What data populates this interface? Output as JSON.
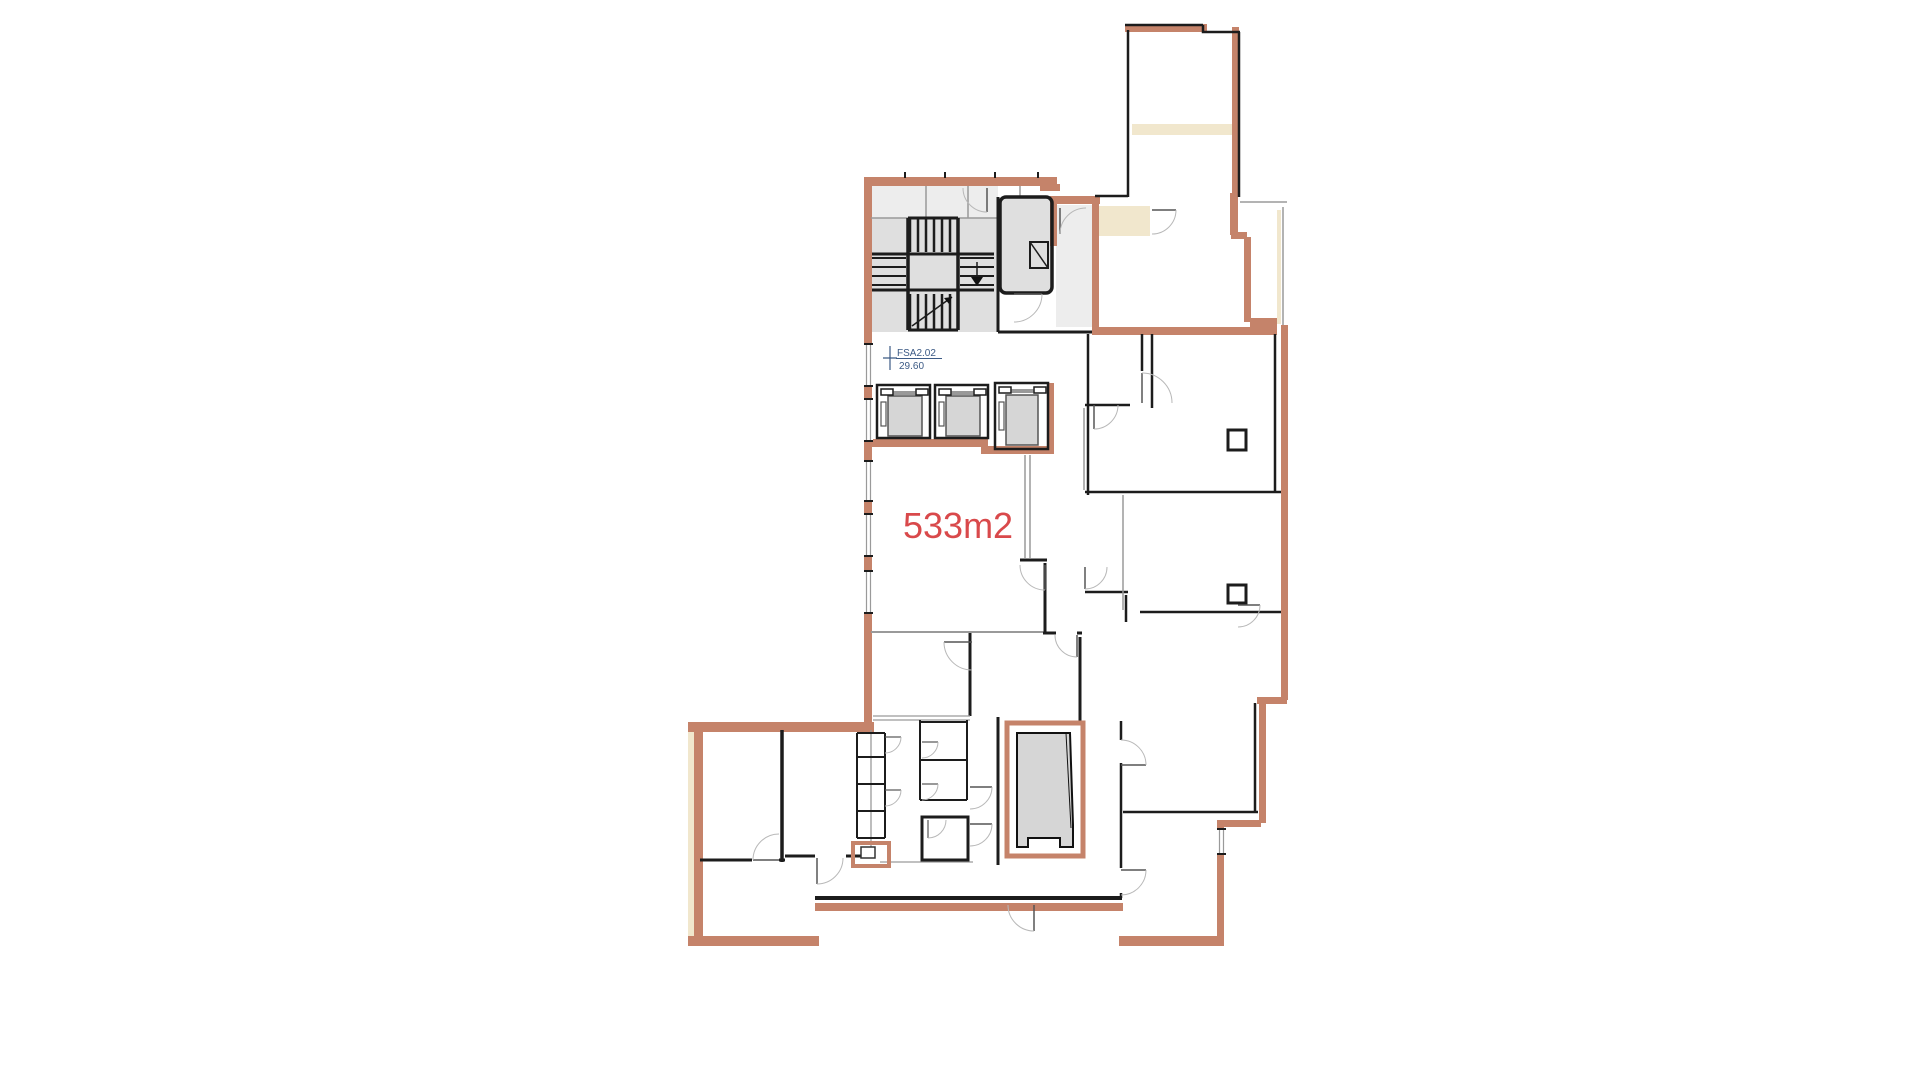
{
  "colors": {
    "exterior_wall": "#c5836a",
    "exterior_wall_light": "#dca991",
    "interior_wall": "#1c1c1c",
    "partition": "#9a9a9a",
    "door_arc": "#b8b8b8",
    "core_fill": "#dfdfdf",
    "core_fill_light": "#ededed",
    "tan_fill": "#f1e7cd",
    "shaft_fill": "#d6d6d6",
    "area_label_color": "#d9494b",
    "room_label_color": "#3c5a85"
  },
  "labels": {
    "area": "533m2",
    "room_id": "FSA2.02",
    "room_value": "29.60"
  }
}
